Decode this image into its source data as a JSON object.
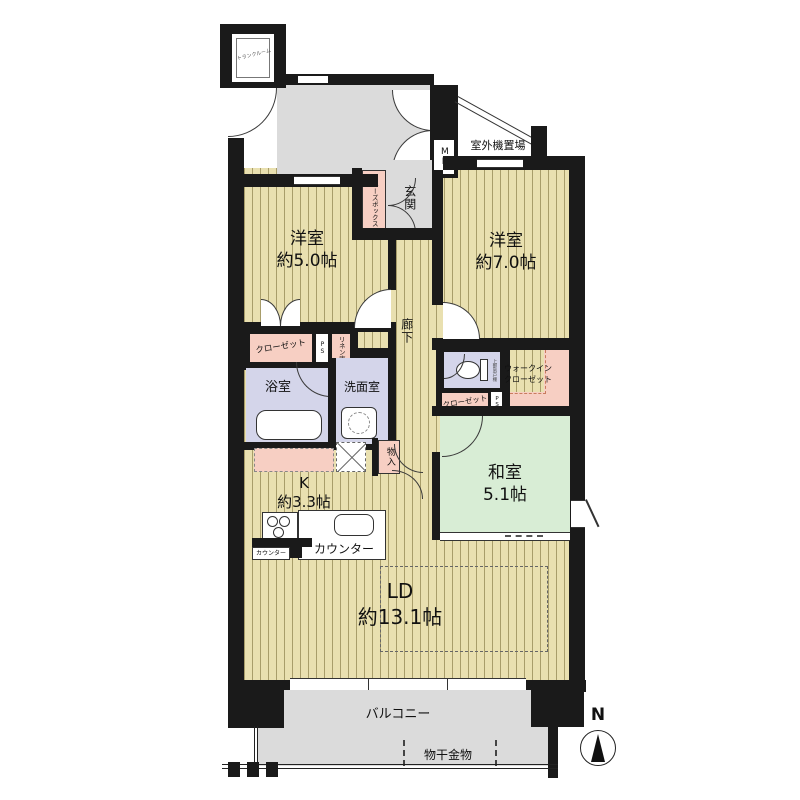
{
  "plan": {
    "type": "apartment-floorplan",
    "compass": "N",
    "rooms": {
      "alcove": "アルコーブ",
      "outdoor_unit": "室外機置場",
      "meter_box": "MB",
      "entrance": "玄関",
      "shoe_box": "シューズボックス",
      "trunk_room": "トランクルーム",
      "bedroom_west": {
        "name": "洋室",
        "size": "約5.0帖"
      },
      "bedroom_east": {
        "name": "洋室",
        "size": "約7.0帖"
      },
      "corridor": "廊下",
      "closet_west": "クローゼット",
      "pipe_space_1": "PS",
      "linen_closet": "リネン庫",
      "bathroom": "浴室",
      "washroom": "洗面室",
      "toilet_shelf": "上部吊戸棚",
      "walk_in_closet": [
        "ウォークイン",
        "クローゼット"
      ],
      "closet_east": "クローゼット",
      "pipe_space_2": "PS",
      "japanese_room": {
        "name": "和室",
        "size": "5.1帖"
      },
      "kitchen": {
        "name": "K",
        "size": "約3.3帖"
      },
      "storage": "物入",
      "counter_main": "カウンター",
      "counter_sub": "カウンター",
      "living_dining": {
        "name": "LD",
        "size": "約13.1帖"
      },
      "balcony": "バルコニー",
      "laundry_hanger": "物干金物"
    },
    "colors": {
      "wall": "#1a1a1a",
      "wood": "#e9e0b0",
      "stripe": "#a89d6a",
      "tatami": "#d8edd5",
      "wet": "#d4d5ea",
      "pink": "#f7cfc3",
      "gray": "#dbdbdb",
      "dashpink": "#c97b5e"
    }
  }
}
